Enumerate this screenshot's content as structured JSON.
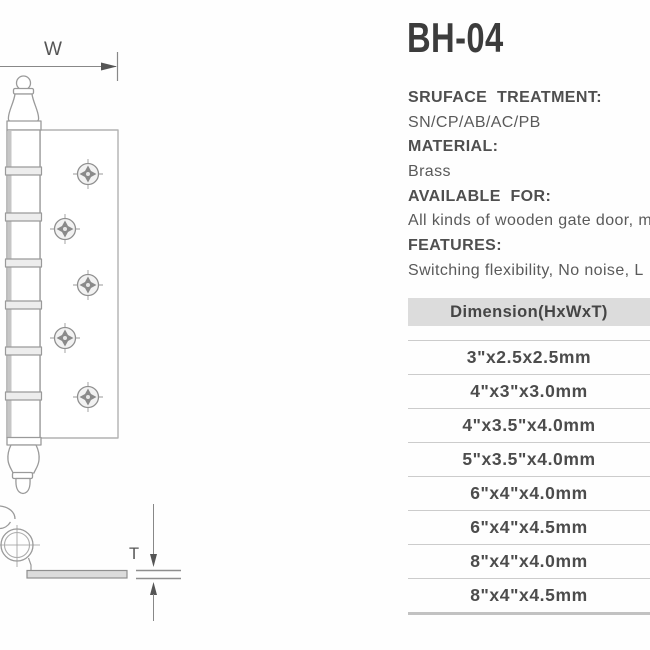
{
  "colors": {
    "background": "#fefefe",
    "title_text": "#3c3c3c",
    "spec_label_text": "#4f4f4f",
    "spec_value_text": "#5a5a5a",
    "table_header_bg": "#dcdcdc",
    "table_header_text": "#454545",
    "table_row_text": "#4c4c4c",
    "table_row_line": "#cccccc",
    "table_end_line": "#c2c2c2",
    "drawing_line": "#9a9a9a",
    "dimension_arrow": "#555555"
  },
  "product": {
    "model": "BH-04",
    "specs": [
      {
        "label": "SRUFACE  TREATMENT:",
        "value": "SN/CP/AB/AC/PB"
      },
      {
        "label": "MATERIAL:",
        "value": "Brass"
      },
      {
        "label": "AVAILABLE  FOR:",
        "value": "All kinds of wooden gate door, m"
      },
      {
        "label": "FEATURES:",
        "value": "Switching flexibility, No noise, L"
      }
    ]
  },
  "dimension_table": {
    "header": "Dimension(HxWxT)",
    "rows": [
      "3\"x2.5x2.5mm",
      "4\"x3\"x3.0mm",
      "4\"x3.5\"x4.0mm",
      "5\"x3.5\"x4.0mm",
      "6\"x4\"x4.0mm",
      "6\"x4\"x4.5mm",
      "8\"x4\"x4.0mm",
      "8\"x4\"x4.5mm"
    ]
  },
  "drawing": {
    "width_label": "W",
    "thickness_label": "T"
  }
}
